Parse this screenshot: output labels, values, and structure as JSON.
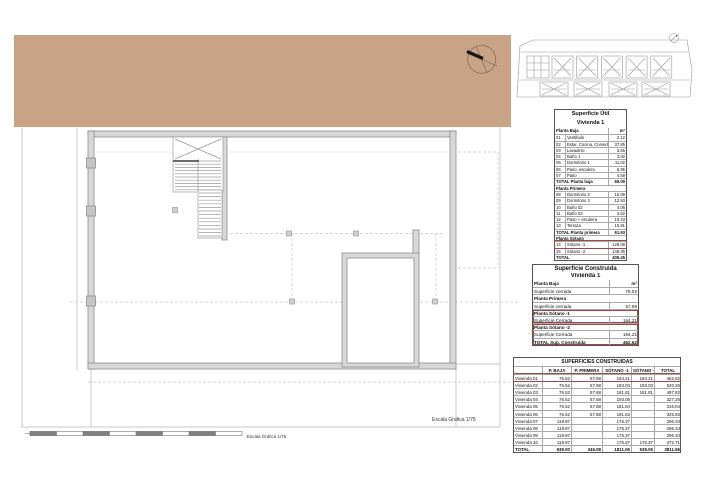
{
  "colors": {
    "terrain": "#c9a385",
    "wall_fill": "#d8d8d8",
    "wall_stroke": "#8e8e8e",
    "highlight_red": "#9a4a42",
    "line_light": "#b5b5b5"
  },
  "icons": {
    "north_arrow": "north-arrow-compass-icon",
    "site_compass": "mini-compass-icon"
  },
  "scale": {
    "label": "Escala Grafica 1/75"
  },
  "tables": {
    "util": {
      "title": "Superficie Útil",
      "subtitle": "Vivienda 1",
      "rows": [
        {
          "t": "h",
          "l": "Planta Baja",
          "v": "m²"
        },
        {
          "t": "i",
          "c": "01",
          "l": "Vestíbulo",
          "v": "2.12"
        },
        {
          "t": "i",
          "c": "02",
          "l": "Estar, Cocina, Comedor",
          "v": "37.85"
        },
        {
          "t": "i",
          "c": "03",
          "l": "Lavadero",
          "v": "3.65"
        },
        {
          "t": "i",
          "c": "04",
          "l": "Baño 1",
          "v": "3.92"
        },
        {
          "t": "i",
          "c": "05",
          "l": "Dormitorio 1",
          "v": "11.02"
        },
        {
          "t": "i",
          "c": "06",
          "l": "Paso, escalera",
          "v": "5.95"
        },
        {
          "t": "i",
          "c": "07",
          "l": "Patio",
          "v": "4.58"
        },
        {
          "t": "t",
          "l": "TOTAL Planta baja",
          "v": "69.09"
        },
        {
          "t": "h",
          "l": "Planta Primera",
          "v": ""
        },
        {
          "t": "i",
          "c": "08",
          "l": "Dormitorio 2",
          "v": "15.08"
        },
        {
          "t": "i",
          "c": "09",
          "l": "Dormitorio 3",
          "v": "12.93"
        },
        {
          "t": "i",
          "c": "10",
          "l": "Baño 02",
          "v": "4.06"
        },
        {
          "t": "i",
          "c": "11",
          "l": "Baño 03",
          "v": "3.62"
        },
        {
          "t": "i",
          "c": "12",
          "l": "Paso + escalera",
          "v": "10.43"
        },
        {
          "t": "i",
          "c": "13",
          "l": "Terraza",
          "v": "15.81"
        },
        {
          "t": "t",
          "l": "TOTAL Planta primera",
          "v": "61.93"
        },
        {
          "t": "h",
          "l": "Planta Sótano",
          "v": ""
        },
        {
          "t": "i",
          "c": "14",
          "l": "Sótano -1",
          "v": "128.06",
          "hl": true
        },
        {
          "t": "i",
          "c": "15",
          "l": "Sótano -2",
          "v": "146.35"
        },
        {
          "t": "t",
          "l": "TOTAL",
          "v": "405.45"
        }
      ]
    },
    "construida": {
      "title": "Superficie Construida",
      "subtitle": "Vivienda 1",
      "rows": [
        {
          "l": "Planta Baja",
          "v": "m²",
          "b": true
        },
        {
          "l": "Superficie cerrada",
          "v": "76.52"
        },
        {
          "l": "Planta Primera",
          "v": "",
          "b": true
        },
        {
          "l": "Superficie cerrada",
          "v": "57.68"
        },
        {
          "l": "Planta Sótano -1",
          "v": "",
          "b": true,
          "hl": "t"
        },
        {
          "l": "Superficie Cerrada",
          "v": "164.21",
          "hl": "b"
        },
        {
          "l": "Planta Sótano -2",
          "v": "",
          "b": true,
          "hl": "t"
        },
        {
          "l": "Superficie Cerrada",
          "v": "164.21",
          "hl": "m"
        },
        {
          "l": "TOTAL Sup. Construida",
          "v": "462.62",
          "b": true,
          "hl": "b"
        }
      ]
    },
    "resumen": {
      "title": "SUPERFICIES CONSTRUIDAS",
      "columns": [
        "",
        "P. BAJA",
        "P. PRIMERA",
        "SÓTANO -1",
        "SÓTANO -2",
        "TOTAL"
      ],
      "rows": [
        [
          "Vivienda 01",
          "76.52",
          "57.68",
          "164.21",
          "164.21",
          "462.62"
        ],
        [
          "Vivienda 02",
          "76.52",
          "57.68",
          "193.03",
          "193.03",
          "520.26"
        ],
        [
          "Vivienda 03",
          "76.52",
          "57.68",
          "181.81",
          "181.81",
          "497.82"
        ],
        [
          "Vivienda 04",
          "76.52",
          "57.68",
          "193.06",
          "",
          "327.26"
        ],
        [
          "Vivienda 05",
          "76.52",
          "57.68",
          "181.84",
          "",
          "316.04"
        ],
        [
          "Vivienda 06",
          "76.52",
          "57.68",
          "191.63",
          "",
          "325.83"
        ],
        [
          "Vivienda 07",
          "119.97",
          "",
          "176.37",
          "",
          "296.34"
        ],
        [
          "Vivienda 08",
          "119.97",
          "",
          "176.37",
          "",
          "296.34"
        ],
        [
          "Vivienda 09",
          "119.97",
          "",
          "176.37",
          "",
          "296.34"
        ],
        [
          "Vivienda 10",
          "119.97",
          "",
          "176.37",
          "176.37",
          "472.71"
        ]
      ],
      "total_row": [
        "TOTAL",
        "939.00",
        "346.08",
        "1811.06",
        "539.05",
        "3811.56"
      ],
      "highlight_row": 0
    }
  }
}
